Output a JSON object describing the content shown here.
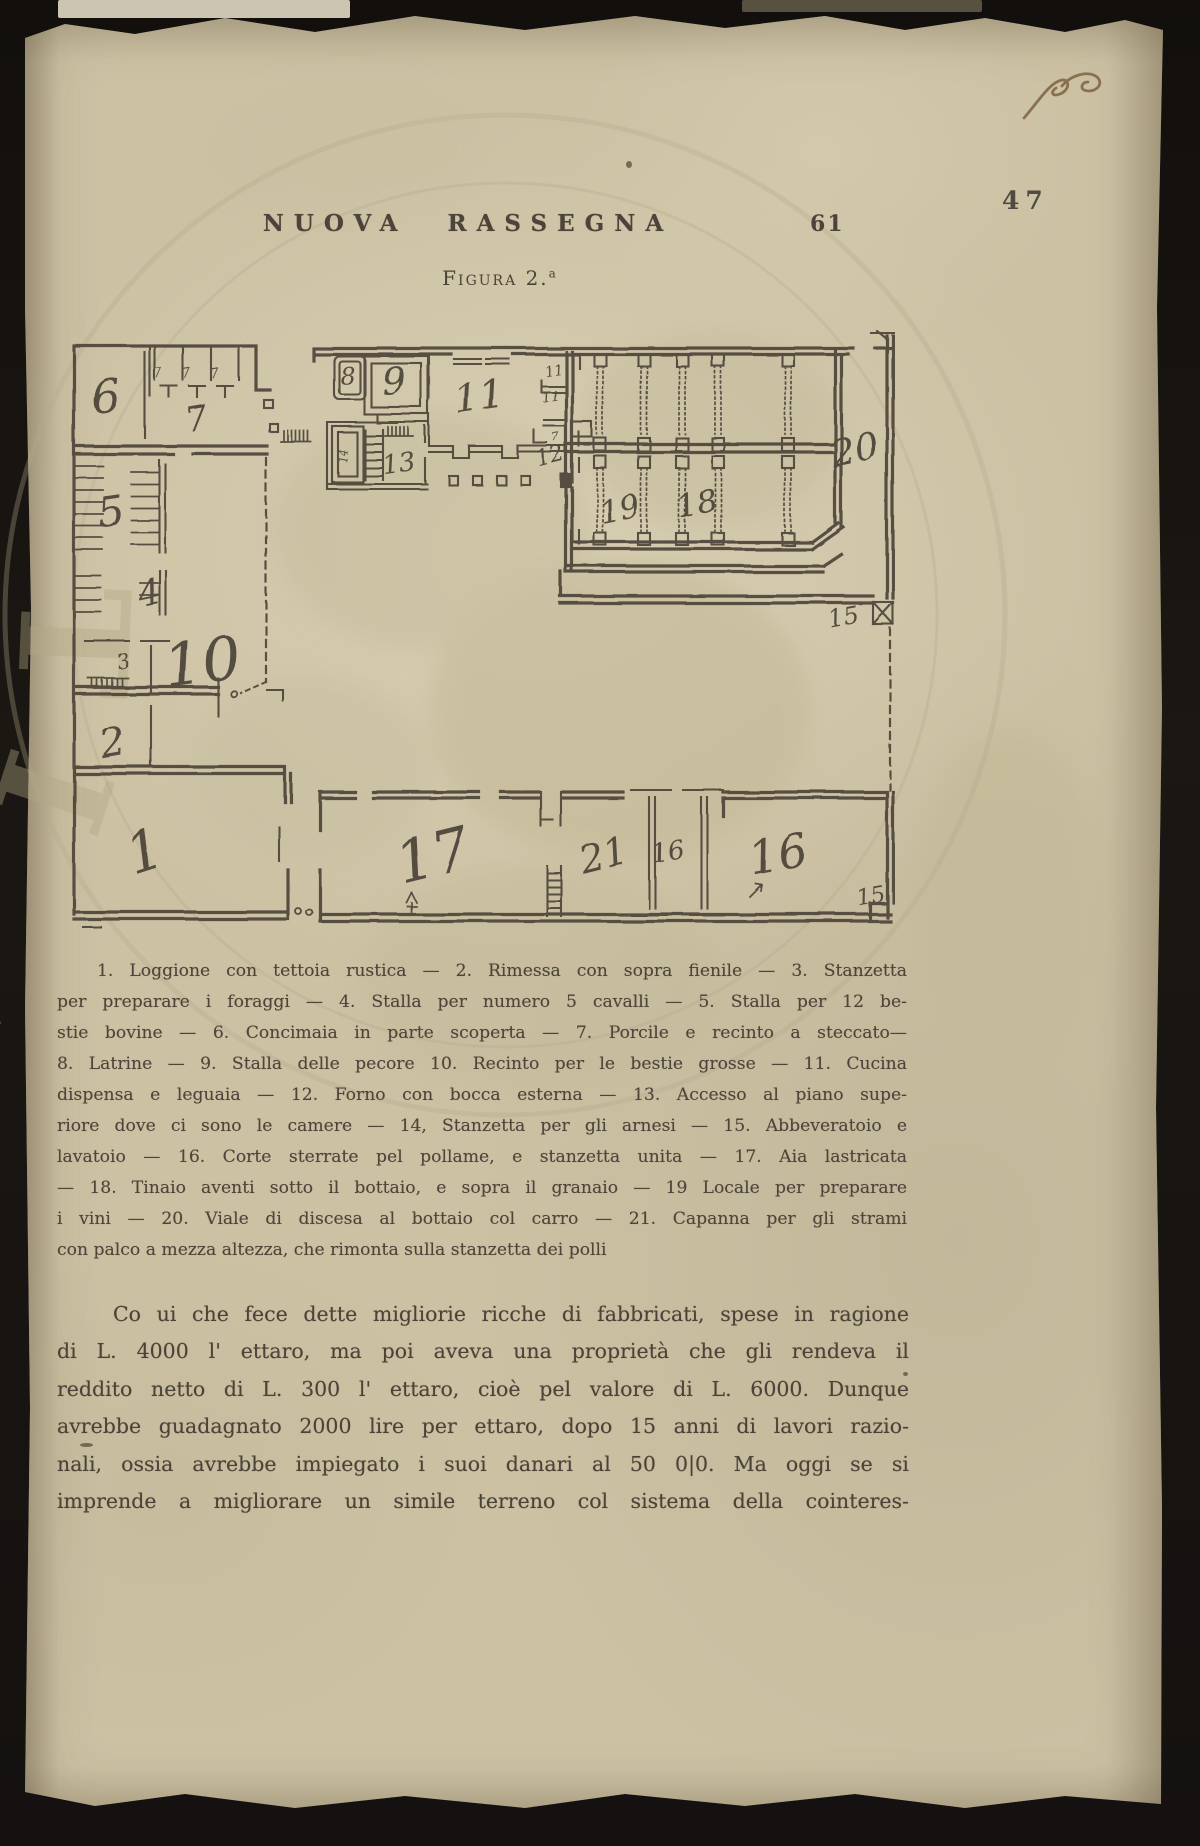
{
  "header": {
    "journal_title": "NUOVA RASSEGNA",
    "page_number": "61",
    "corner_number": "47"
  },
  "figure": {
    "title": "Figura 2.",
    "title_sup": "a",
    "room_labels": [
      "6",
      "7",
      "7",
      "7",
      "7",
      "5",
      "4",
      "3",
      "10",
      "2",
      "1",
      "8",
      "9",
      "14",
      "13",
      "11",
      "11",
      "11",
      "7",
      "12",
      "19",
      "18",
      "20",
      "15",
      "17",
      "21",
      "16",
      "16",
      "15"
    ]
  },
  "caption_lines": [
    "1. Loggione con tettoia rustica — 2. Rimessa con sopra fienile — 3. Stanzetta",
    "per preparare i foraggi — 4. Stalla per numero 5 cavalli — 5. Stalla per 12 be-",
    "stie bovine — 6. Concimaia in parte scoperta — 7. Porcile e recinto a steccato—",
    "8. Latrine — 9. Stalla delle pecore 10. Recinto per le bestie grosse — 11. Cucina",
    "dispensa e leguaia — 12. Forno con bocca esterna — 13. Accesso al piano supe-",
    "riore dove ci sono le camere — 14, Stanzetta per gli arnesi — 15. Abbeveratoio e",
    "lavatoio — 16. Corte sterrate pel pollame, e stanzetta unita — 17. Aia lastricata",
    "— 18. Tinaio aventi sotto il bottaio, e sopra il granaio — 19 Locale per preparare",
    "i vini — 20. Viale di discesa al bottaio col carro — 21. Capanna per gli strami",
    "con palco a mezza altezza, che rimonta sulla stanzetta dei polli"
  ],
  "body_lines": [
    "Co ui che fece dette migliorie ricche di fabbricati, spese in ragione",
    "di L. 4000 l' ettaro, ma poi aveva una proprietà che gli rendeva il",
    "reddito netto di L. 300 l' ettaro, cioè pel valore di L. 6000. Dunque",
    "avrebbe guadagnato 2000 lire per ettaro, dopo 15 anni di lavori razio-",
    "nali, ossia avrebbe impiegato i suoi danari al 50 0|0. Ma oggi se si",
    "imprende a migliorare un simile terreno col sistema della cointeres-"
  ],
  "stamp_text": "TI PVBLICAE AVGENDA",
  "colors": {
    "paper": "#ccc1a3",
    "ink": "#4a4238",
    "plan_ink": "#4b4238",
    "stamp": "#b2a884",
    "handwriting": "#7d6342"
  }
}
